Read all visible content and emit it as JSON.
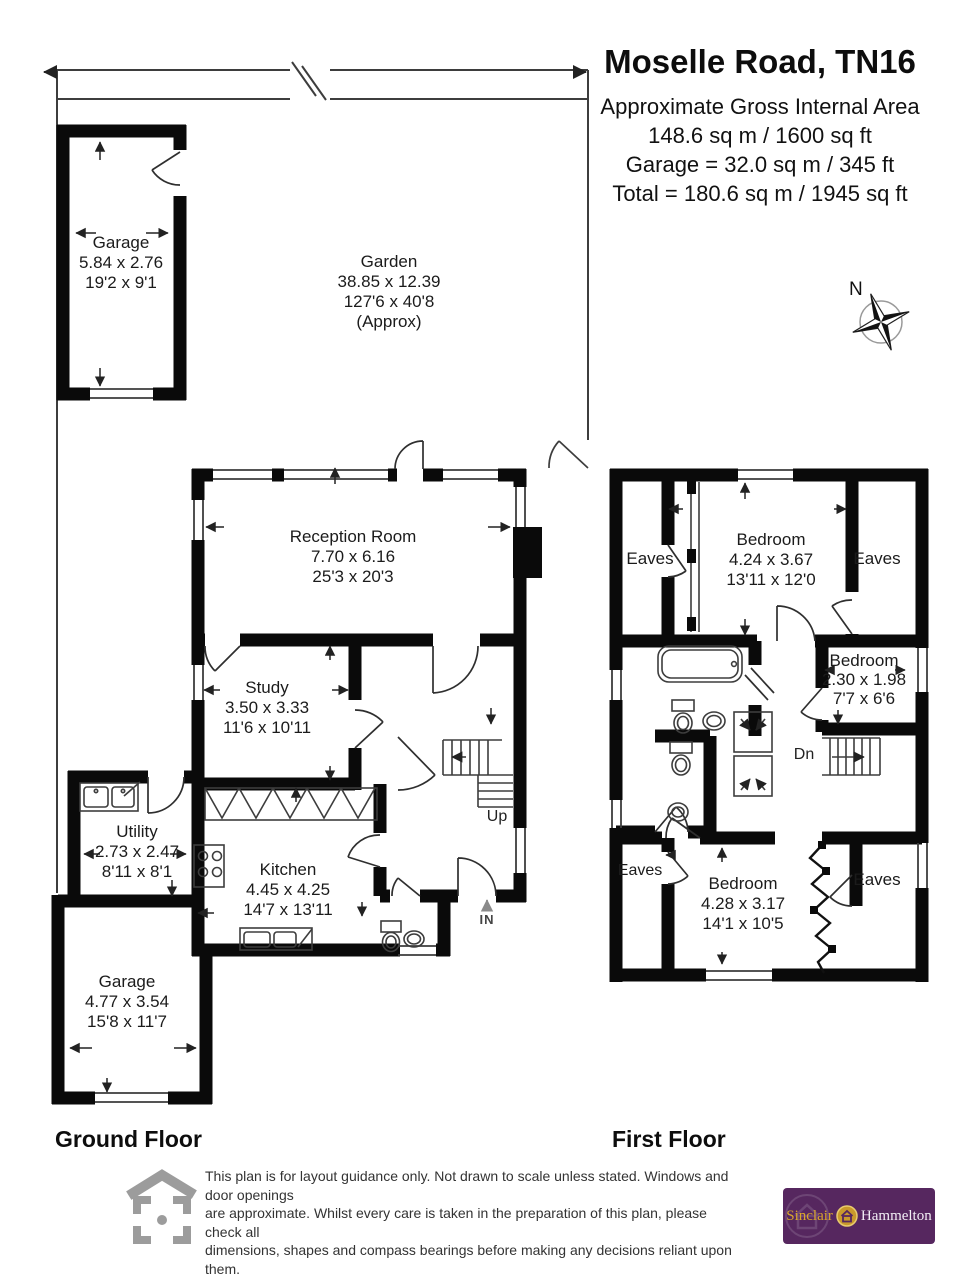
{
  "header": {
    "title": "Moselle Road, TN16",
    "area_line_1": "Approximate Gross Internal Area",
    "area_line_2": "148.6 sq m / 1600 sq ft",
    "area_line_3": "Garage = 32.0 sq m / 345 ft",
    "area_line_4": "Total = 180.6 sq m / 1945 sq ft"
  },
  "compass": {
    "north_label": "N"
  },
  "ground_floor": {
    "section_label": "Ground Floor",
    "garage_top": {
      "name": "Garage",
      "metric": "5.84 x 2.76",
      "imperial": "19'2 x 9'1"
    },
    "garden": {
      "name": "Garden",
      "metric": "38.85 x 12.39",
      "imperial": "127'6 x 40'8",
      "note": "(Approx)"
    },
    "reception": {
      "name": "Reception Room",
      "metric": "7.70 x 6.16",
      "imperial": "25'3 x 20'3"
    },
    "study": {
      "name": "Study",
      "metric": "3.50 x 3.33",
      "imperial": "11'6 x 10'11"
    },
    "utility": {
      "name": "Utility",
      "metric": "2.73 x 2.47",
      "imperial": "8'11 x 8'1"
    },
    "kitchen": {
      "name": "Kitchen",
      "metric": "4.45 x 4.25",
      "imperial": "14'7 x 13'11"
    },
    "garage_bottom": {
      "name": "Garage",
      "metric": "4.77 x 3.54",
      "imperial": "15'8 x 11'7"
    },
    "stairs_label": "Up",
    "entrance_label": "IN"
  },
  "first_floor": {
    "section_label": "First Floor",
    "bedroom_top": {
      "name": "Bedroom",
      "metric": "4.24 x 3.67",
      "imperial": "13'11 x 12'0"
    },
    "bedroom_mid": {
      "name": "Bedroom",
      "metric": "2.30 x 1.98",
      "imperial": "7'7 x 6'6"
    },
    "bedroom_bottom": {
      "name": "Bedroom",
      "metric": "4.28 x 3.17",
      "imperial": "14'1 x 10'5"
    },
    "eaves_top_left": "Eaves",
    "eaves_top_right": "Eaves",
    "eaves_bottom_left": "Eaves",
    "eaves_bottom_right": "Eaves",
    "stairs_label": "Dn"
  },
  "footer": {
    "disclaimer_line_1": "This plan is for layout guidance only. Not drawn to scale unless stated. Windows and door openings",
    "disclaimer_line_2": "are approximate. Whilst every care is taken in the preparation of this plan, please check all",
    "disclaimer_line_3": "dimensions, shapes and compass bearings before making any decisions reliant upon them.",
    "produced_by": "Produced By Planpix",
    "brand_left": "Sinclair",
    "brand_right": "Hammelton"
  },
  "colors": {
    "wall": "#0a0a0a",
    "line": "#3d3d3d",
    "brand_purple": "#56275f",
    "brand_gold": "#c9992b",
    "logo_gray": "#9c9c9c"
  }
}
